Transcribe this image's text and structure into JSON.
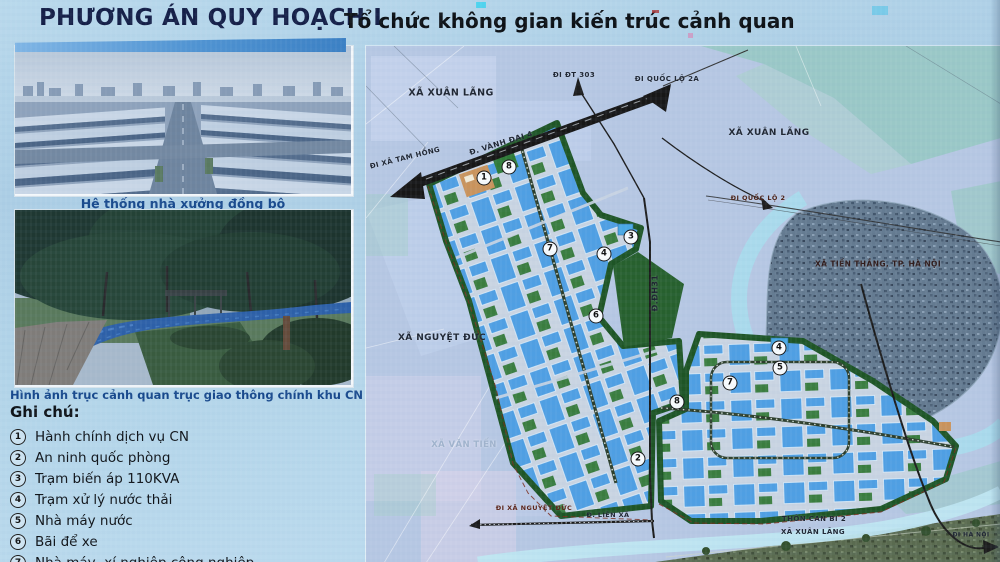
{
  "header": {
    "title_main": "PHƯƠNG ÁN QUY HOẠCH I",
    "title_sub": "Tổ chức không gian kiến trúc cảnh quan"
  },
  "left_panel": {
    "photo1_caption": "Hệ thống nhà xưởng đồng bộ",
    "photo2_caption": "Hình ảnh trục cảnh quan trục giao thông chính khu CN",
    "legend_title": "Ghi chú:",
    "legend_items": [
      {
        "num": "1",
        "label": "Hành chính dịch vụ CN"
      },
      {
        "num": "2",
        "label": "An ninh quốc phòng"
      },
      {
        "num": "3",
        "label": "Trạm biến áp 110KVA"
      },
      {
        "num": "4",
        "label": "Trạm xử lý nước thải"
      },
      {
        "num": "5",
        "label": "Nhà máy nước"
      },
      {
        "num": "6",
        "label": "Bãi để xe"
      },
      {
        "num": "7",
        "label": "Nhà máy, xí nghiệp công nghiệp"
      }
    ]
  },
  "map": {
    "labels": [
      {
        "text": "XÃ XUÂN LÃNG"
      },
      {
        "text": "ĐI ĐT 303"
      },
      {
        "text": "ĐI QUỐC LỘ 2A"
      },
      {
        "text": "Đ. VÀNH ĐAI 4"
      },
      {
        "text": "ĐI XÃ TAM HỒNG"
      },
      {
        "text": "XÃ XUÂN LÃNG"
      },
      {
        "text": "ĐI QUỐC LỘ 2"
      },
      {
        "text": "XÃ TIẾN THẮNG, TP. HÀ NỘI"
      },
      {
        "text": "Đ.ĐH31"
      },
      {
        "text": "XÃ NGUYỆT ĐỨC"
      },
      {
        "text": "XÃ VĂN TIẾN"
      },
      {
        "text": "ĐI XÃ NGUYỆT ĐỨC"
      },
      {
        "text": "Đ. LIÊN XÃ"
      },
      {
        "text": "THÔN CAN BI 2"
      },
      {
        "text": "XÃ XUÂN LÃNG"
      },
      {
        "text": "ĐI HÀ NỘI"
      }
    ],
    "markers": [
      {
        "n": "1"
      },
      {
        "n": "8"
      },
      {
        "n": "7"
      },
      {
        "n": "3"
      },
      {
        "n": "4"
      },
      {
        "n": "6"
      },
      {
        "n": "4"
      },
      {
        "n": "5"
      },
      {
        "n": "7"
      },
      {
        "n": "8"
      },
      {
        "n": "2"
      }
    ]
  },
  "colors": {
    "slide_bg": "#b2d4e9",
    "title_navy": "#141e47",
    "caption_blue": "#17488c",
    "building_blue": "#4f9fe3",
    "cluster_green": "#1e5526",
    "road_black": "#171717",
    "map_bg": "#b6c7e3",
    "river_blue": "#a9dcec"
  }
}
